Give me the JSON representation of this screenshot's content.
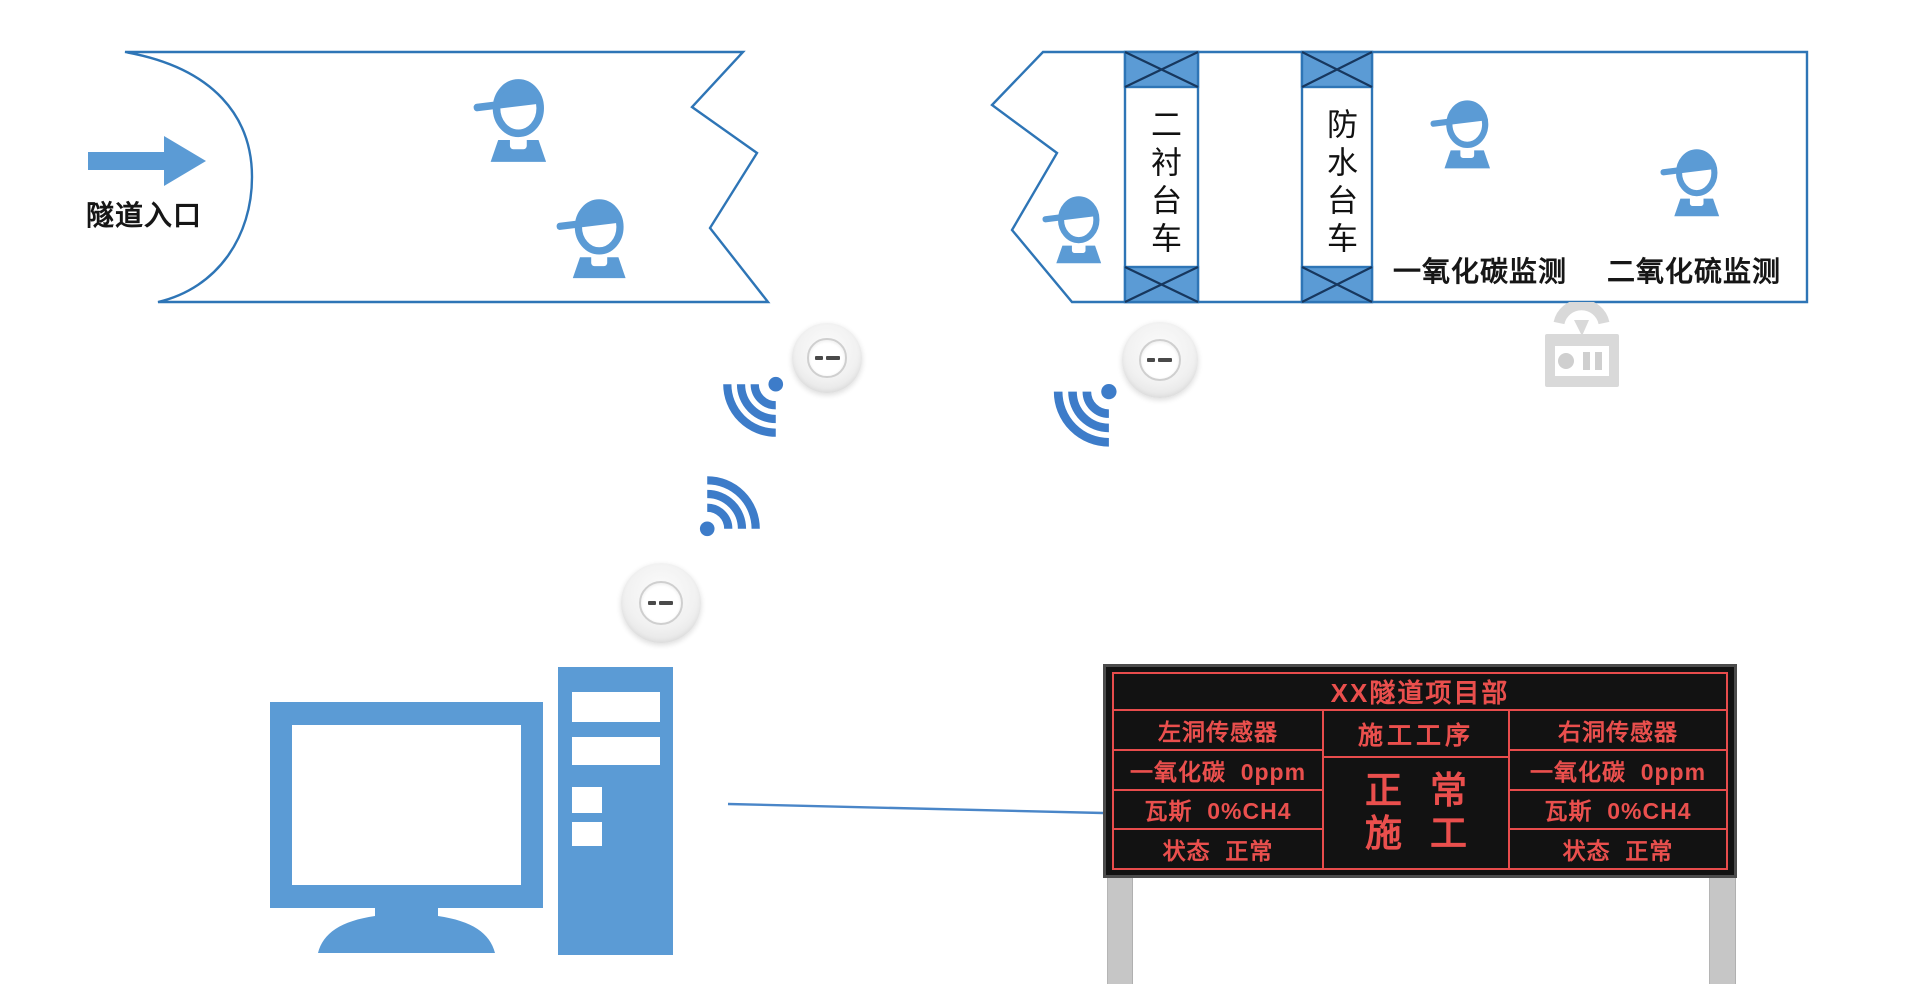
{
  "colors": {
    "primary_blue": "#5B9BD5",
    "outline_blue": "#2E75B6",
    "wifi_blue": "#3D7CC9",
    "cross_dark": "#17375E",
    "label_black": "#161616",
    "board_background": "#121212",
    "board_red": "#E84C4C",
    "leg_gray": "#C6C6C6",
    "device_gray": "#D9D9D9"
  },
  "left_tunnel": {
    "entrance_label": "隧道入口",
    "worker_count": 2
  },
  "right_tunnel": {
    "worker_count": 3,
    "trolleys": [
      {
        "label": "二衬台车"
      },
      {
        "label": "防水台车"
      }
    ],
    "monitor_labels": [
      {
        "label": "一氧化碳监测"
      },
      {
        "label": "二氧化硫监测"
      }
    ]
  },
  "network": {
    "access_points": [
      {
        "name": "ap-left-tunnel"
      },
      {
        "name": "ap-right-tunnel"
      },
      {
        "name": "ap-control-room"
      }
    ]
  },
  "led_board": {
    "title": "XX隧道项目部",
    "left_column": {
      "header": "左洞传感器",
      "rows": [
        "一氧化碳  0ppm",
        "瓦斯  0%CH4",
        "状态  正常"
      ]
    },
    "middle_column": {
      "header": "施工工序",
      "status_line1": "正常",
      "status_line2": "施工"
    },
    "right_column": {
      "header": "右洞传感器",
      "rows": [
        "一氧化碳  0ppm",
        "瓦斯  0%CH4",
        "状态  正常"
      ]
    }
  }
}
